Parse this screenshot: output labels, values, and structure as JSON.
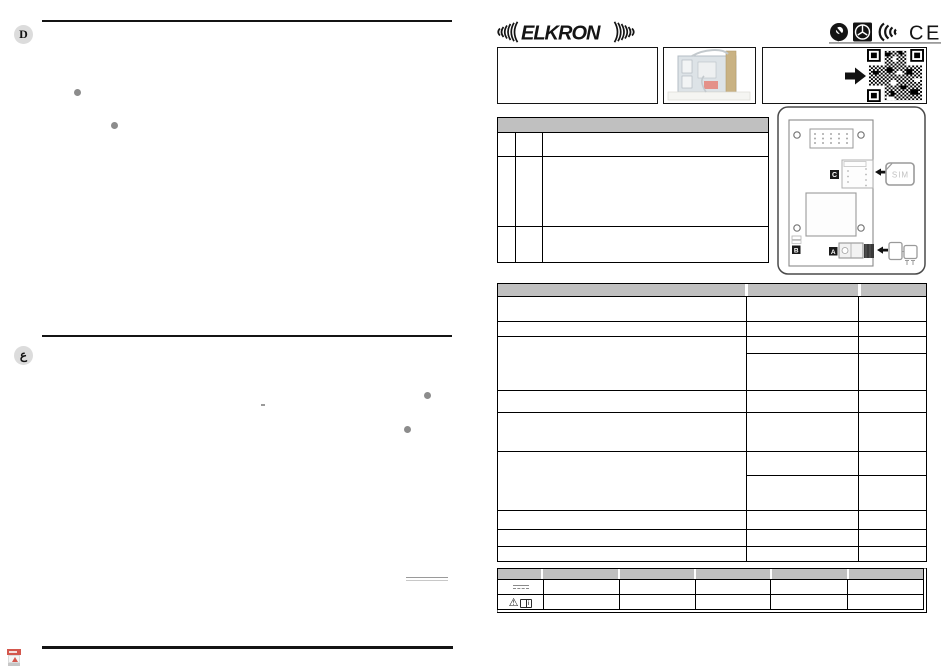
{
  "brand": {
    "name": "ELKRON",
    "logo_waves": "left-and-right-sound-waves"
  },
  "header": {
    "ce_mark": "CE",
    "cert_icon_names": [
      "approval-swirl-icon",
      "security-square-icon",
      "radio-waves-icon",
      "ce-mark"
    ]
  },
  "left_page": {
    "section_d_badge": "D",
    "section_ar_badge": "ع",
    "bullets_d": 2,
    "bullets_ar": 2
  },
  "top_boxes": {
    "title_box": "",
    "photo_box_icon": "product-photo",
    "qr_box_icons": [
      "right-arrow-icon",
      "qr-code"
    ]
  },
  "diagram": {
    "label_a": "A",
    "label_b": "B",
    "label_c": "C",
    "sim_card_label": "SIM",
    "icons": [
      "pin-header",
      "mounting-holes",
      "sim-holder",
      "sim-card",
      "antenna-connector"
    ]
  },
  "components_table": {
    "header": "",
    "rows": 3,
    "columns": 3
  },
  "specifications_table": {
    "header": "",
    "rows": 9,
    "columns": 3,
    "split_rows": [
      3,
      6
    ]
  },
  "ratings_table": {
    "columns": 6,
    "rows": 2,
    "dc_symbol_icon": "dc-voltage-icon",
    "warning_glyph": "⚠",
    "manual_info_glyph": "i"
  },
  "colors": {
    "table_header_gray": "#c0c0c0",
    "border_black": "#000000",
    "badge_gray": "#dcdcdc",
    "bullet_gray": "#8c8c8c",
    "pdf_red": "#cc3a2f",
    "board_gray_blue": "#dde3e7",
    "antenna_tan": "#c9b283"
  }
}
